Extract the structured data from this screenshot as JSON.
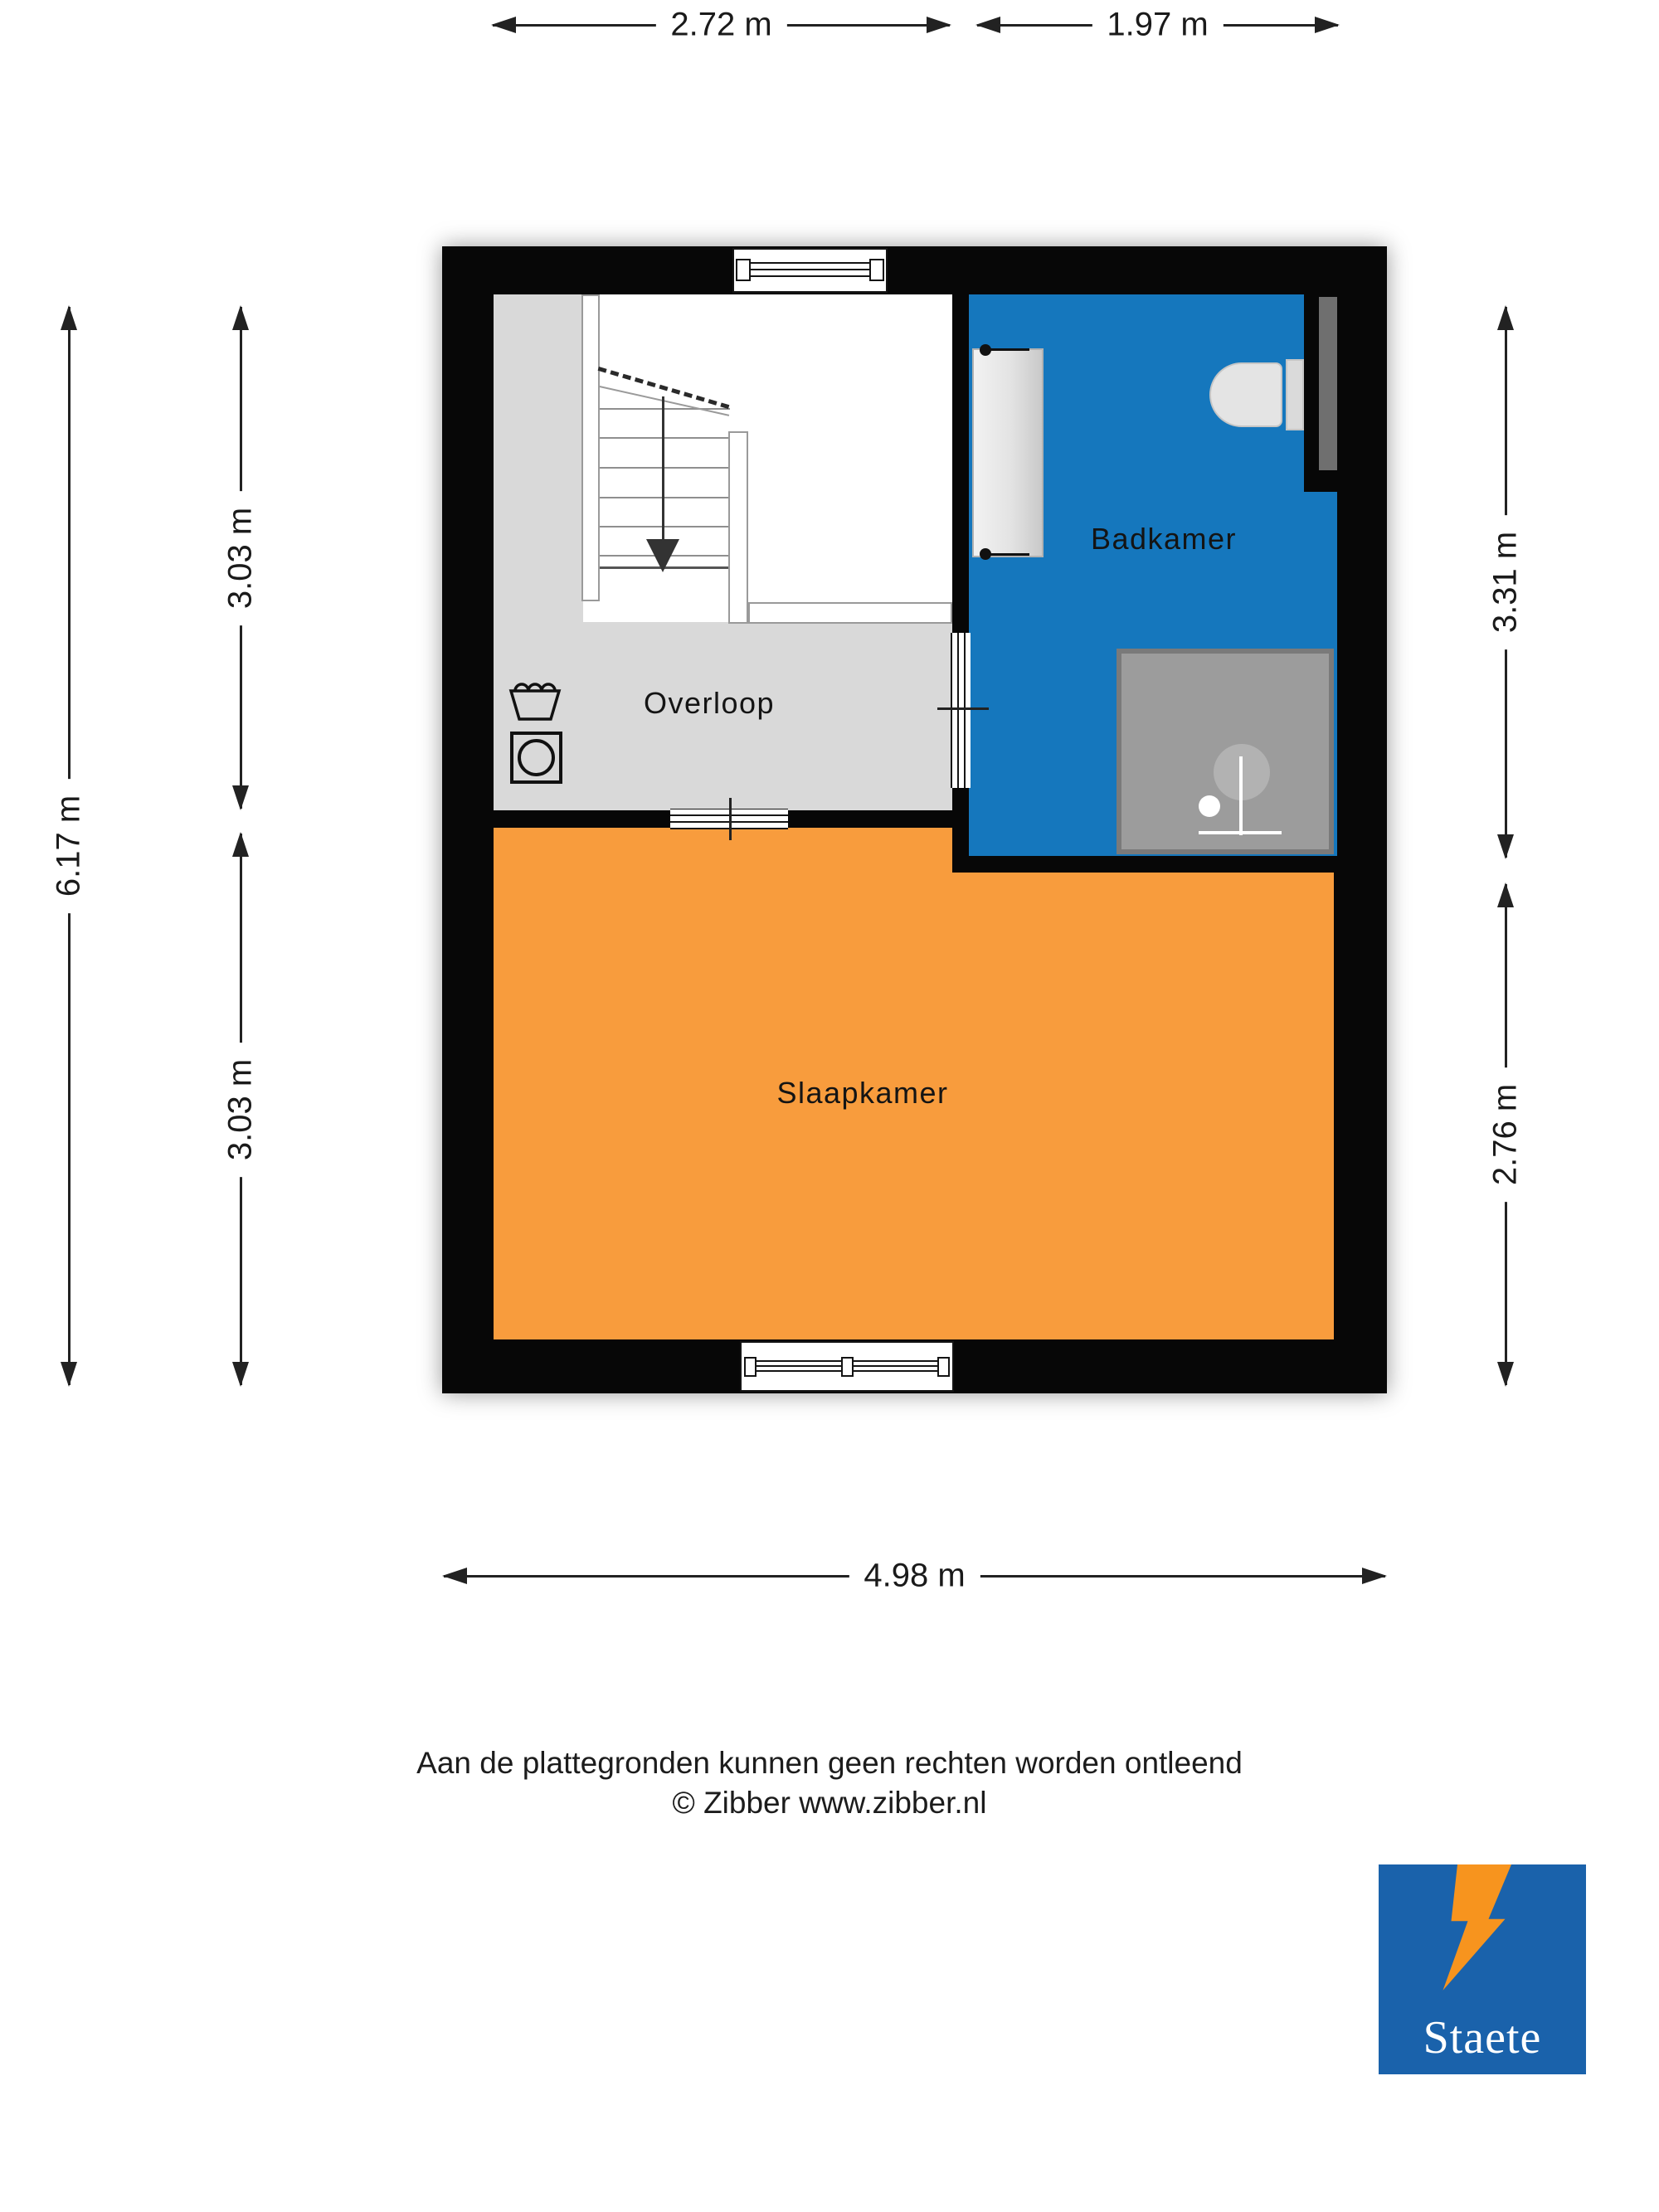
{
  "rooms": [
    {
      "name": "Overloop",
      "color": "#d9d9d9"
    },
    {
      "name": "Badkamer",
      "color": "#1577bd"
    },
    {
      "name": "Slaapkamer",
      "color": "#f89c3d"
    }
  ],
  "dimensions": {
    "top": [
      {
        "label": "2.72 m"
      },
      {
        "label": "1.97 m"
      }
    ],
    "left": [
      {
        "label": "6.17 m"
      },
      {
        "label": "3.03 m"
      },
      {
        "label": "3.03 m"
      }
    ],
    "right": [
      {
        "label": "3.31 m"
      },
      {
        "label": "2.76 m"
      }
    ],
    "bottom": [
      {
        "label": "4.98 m"
      }
    ]
  },
  "disclaimer": {
    "line1": "Aan de plattegronden kunnen geen rechten worden ontleend",
    "line2": "© Zibber www.zibber.nl"
  },
  "logo": {
    "text": "Staete",
    "background": "#1a62ab",
    "accent": "#f7941e"
  },
  "colors": {
    "wall": "#070707",
    "shower": "#9c9c9c",
    "stair_arrow": "#333333",
    "dimension": "#222222"
  },
  "icons": {
    "stair-direction-arrow": "▼ (going down)",
    "laundry-tub": "trapezoid with wavy water line",
    "washing-machine": "square with circle drum",
    "washbasin": "grey counter with two taps",
    "toilet": "bowl with cistern",
    "shower": "grey square with shower head"
  }
}
